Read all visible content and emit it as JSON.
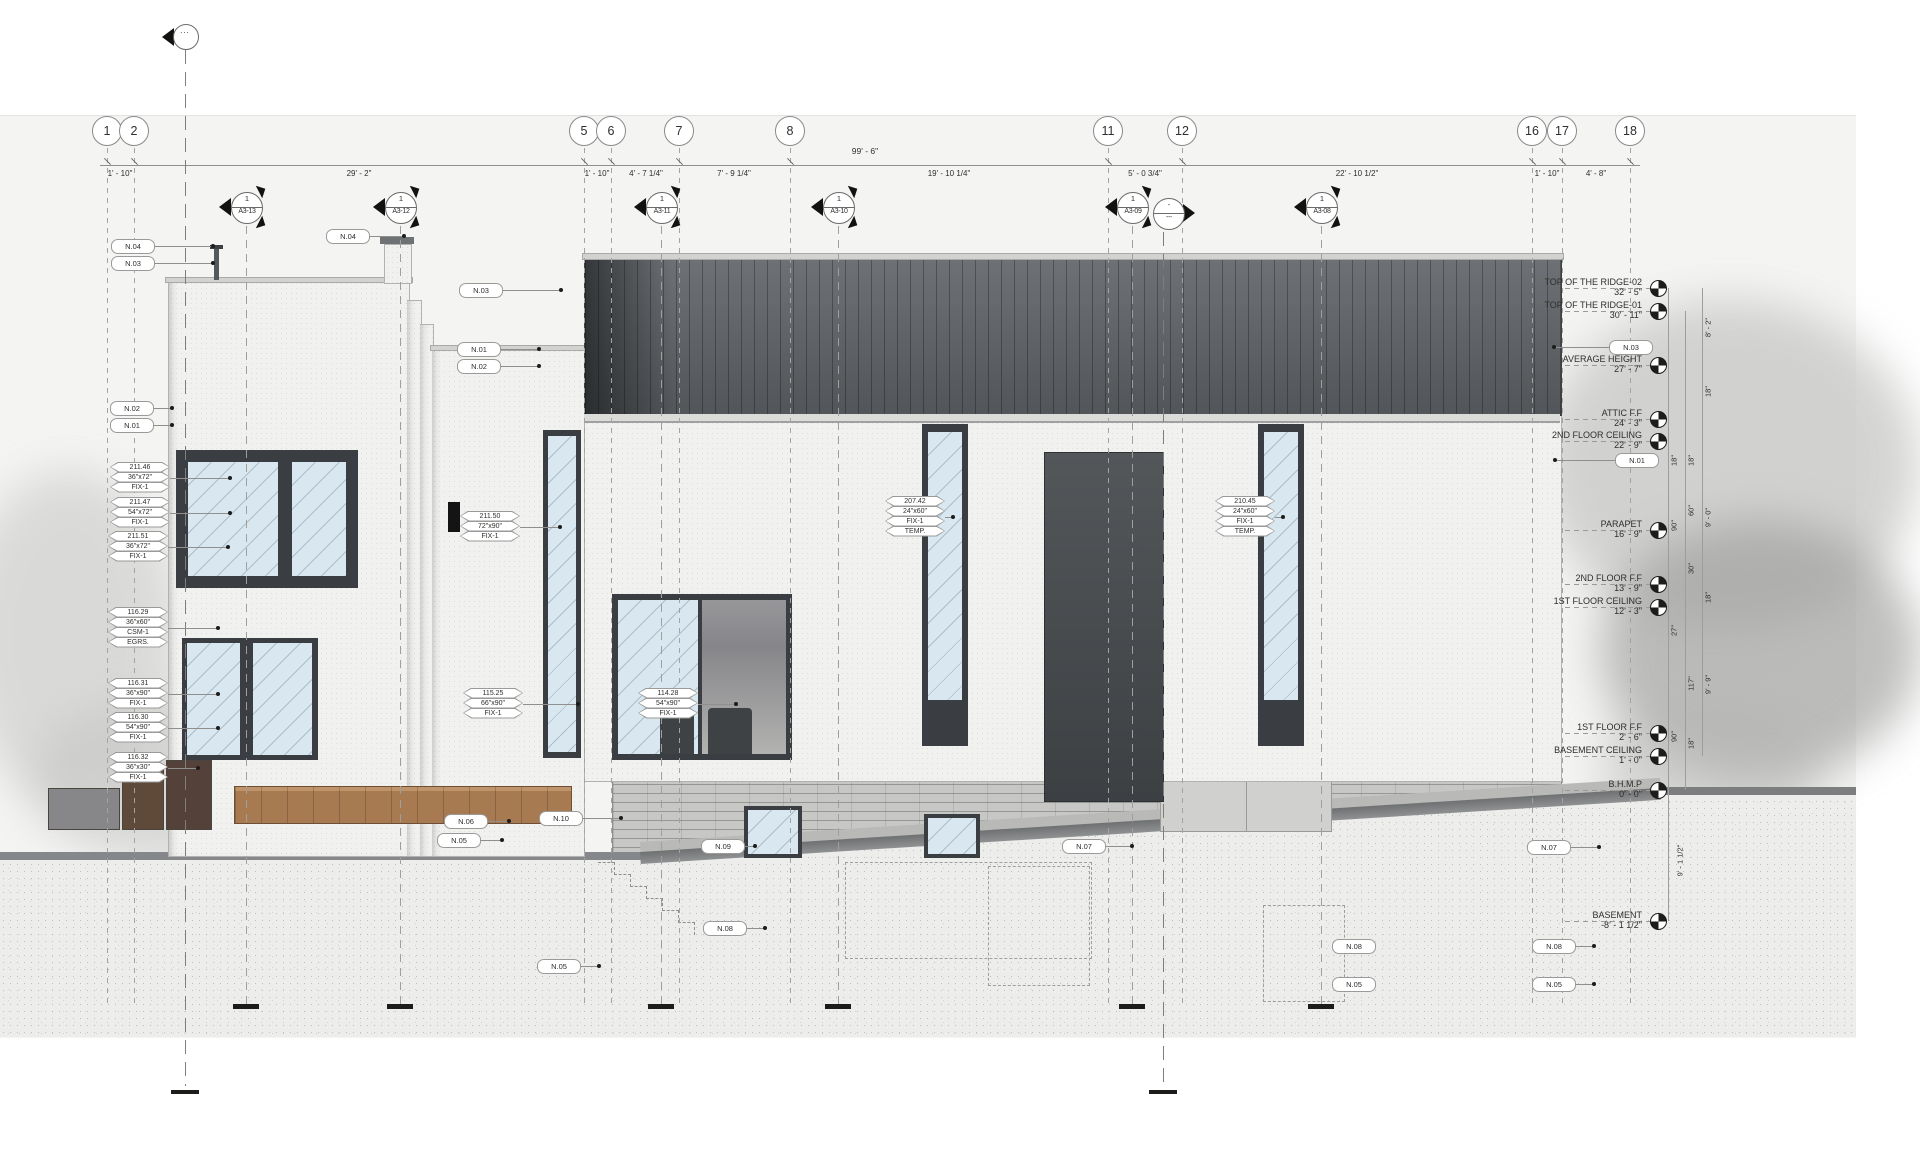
{
  "drawing": {
    "type": "building-elevation",
    "colors": {
      "sheet": "#f4f4f3",
      "roof": "#5d6165",
      "glass": "#d9e8f0",
      "frame": "#3a3e42",
      "deck": "#a87a52",
      "brick": "#c7c7c5",
      "ink": "#2e2e2c"
    }
  },
  "grids": [
    {
      "label": "1",
      "x": 107
    },
    {
      "label": "2",
      "x": 134
    },
    {
      "label": "5",
      "x": 584
    },
    {
      "label": "6",
      "x": 611
    },
    {
      "label": "7",
      "x": 679
    },
    {
      "label": "8",
      "x": 790
    },
    {
      "label": "11",
      "x": 1108
    },
    {
      "label": "12",
      "x": 1182
    },
    {
      "label": "16",
      "x": 1532
    },
    {
      "label": "17",
      "x": 1562
    },
    {
      "label": "18",
      "x": 1630
    }
  ],
  "dims": {
    "overall": "99' - 6\"",
    "overall_x": 865,
    "overall_y": 146,
    "line": {
      "x1": 100,
      "x2": 1640,
      "y": 165
    },
    "segments": [
      {
        "label": "1' - 10\"",
        "x": 120
      },
      {
        "label": "29' - 2\"",
        "x": 359
      },
      {
        "label": "1' - 10\"",
        "x": 597
      },
      {
        "label": "4' - 7 1/4\"",
        "x": 646
      },
      {
        "label": "7' - 9 1/4\"",
        "x": 734
      },
      {
        "label": "19' - 10 1/4\"",
        "x": 949
      },
      {
        "label": "5' - 0 3/4\"",
        "x": 1145
      },
      {
        "label": "22' - 10 1/2\"",
        "x": 1357
      },
      {
        "label": "1' - 10\"",
        "x": 1547
      },
      {
        "label": "4' - 8\"",
        "x": 1596
      }
    ]
  },
  "section_markers": [
    {
      "num": "1",
      "sheet": "A3-13",
      "x": 246
    },
    {
      "num": "1",
      "sheet": "A3-12",
      "x": 400
    },
    {
      "num": "1",
      "sheet": "A3-11",
      "x": 661
    },
    {
      "num": "1",
      "sheet": "A3-10",
      "x": 838
    },
    {
      "num": "1",
      "sheet": "A3-09",
      "x": 1132
    },
    {
      "num": "1",
      "sheet": "A3-08",
      "x": 1321
    }
  ],
  "aux_marker": {
    "top": "-",
    "bottom": "---",
    "x": 1168,
    "y": 213
  },
  "top_marker": {
    "label": "...",
    "x": 185,
    "y": 36
  },
  "prop_lines": [
    {
      "x": 185,
      "y1": 50,
      "y2": 1086,
      "bar_y": 1090
    },
    {
      "x": 1163,
      "y1": 232,
      "y2": 1086,
      "bar_y": 1090
    }
  ],
  "levels": [
    {
      "name": "TOP OF THE RIDGE-02",
      "elev": "32' - 5\"",
      "y": 288
    },
    {
      "name": "TOP OF THE RIDGE-01",
      "elev": "30' - 11\"",
      "y": 311
    },
    {
      "name": "AVERAGE HEIGHT",
      "elev": "27' - 7\"",
      "y": 365
    },
    {
      "name": "ATTIC F.F",
      "elev": "24' - 3\"",
      "y": 419
    },
    {
      "name": "2ND FLOOR CEILING",
      "elev": "22' - 9\"",
      "y": 441
    },
    {
      "name": "PARAPET",
      "elev": "16' - 9\"",
      "y": 530
    },
    {
      "name": "2ND FLOOR F.F",
      "elev": "13' - 9\"",
      "y": 584
    },
    {
      "name": "1ST FLOOR CEILING",
      "elev": "12' - 3\"",
      "y": 607
    },
    {
      "name": "1ST FLOOR F.F",
      "elev": "2' - 6\"",
      "y": 733
    },
    {
      "name": "BASEMENT CEILING",
      "elev": "1' - 0\"",
      "y": 756
    },
    {
      "name": "B.H.M.P",
      "elev": "0' - 0\"",
      "y": 790
    },
    {
      "name": "BASEMENT",
      "elev": "-8' - 1 1/2\"",
      "y": 921
    }
  ],
  "vdim_lines": [
    {
      "x": 1668,
      "y1": 288,
      "y2": 921
    },
    {
      "x": 1685,
      "y1": 311,
      "y2": 790
    },
    {
      "x": 1702,
      "y1": 288,
      "y2": 756
    }
  ],
  "vdims": [
    {
      "label": "8' - 2\"",
      "x": 1708,
      "y": 328
    },
    {
      "label": "18\"",
      "x": 1708,
      "y": 392
    },
    {
      "label": "18\"",
      "x": 1674,
      "y": 461
    },
    {
      "label": "18\"",
      "x": 1691,
      "y": 461
    },
    {
      "label": "90\"",
      "x": 1674,
      "y": 526
    },
    {
      "label": "60\"",
      "x": 1691,
      "y": 511
    },
    {
      "label": "9' - 0\"",
      "x": 1708,
      "y": 518
    },
    {
      "label": "30\"",
      "x": 1691,
      "y": 569
    },
    {
      "label": "18\"",
      "x": 1708,
      "y": 598
    },
    {
      "label": "27\"",
      "x": 1674,
      "y": 631
    },
    {
      "label": "117\"",
      "x": 1691,
      "y": 684
    },
    {
      "label": "9' - 9\"",
      "x": 1708,
      "y": 685
    },
    {
      "label": "90\"",
      "x": 1674,
      "y": 737
    },
    {
      "label": "18\"",
      "x": 1691,
      "y": 744
    },
    {
      "label": "9' - 1 1/2\"",
      "x": 1680,
      "y": 861
    }
  ],
  "keynotes": [
    {
      "label": "N.04",
      "x": 132,
      "y": 246,
      "dir": "r",
      "len": 60
    },
    {
      "label": "N.03",
      "x": 132,
      "y": 263,
      "dir": "r",
      "len": 60
    },
    {
      "label": "N.02",
      "x": 131,
      "y": 408,
      "dir": "r",
      "len": 20
    },
    {
      "label": "N.01",
      "x": 131,
      "y": 425,
      "dir": "r",
      "len": 20
    },
    {
      "label": "N.04",
      "x": 347,
      "y": 236,
      "dir": "r",
      "len": 36
    },
    {
      "label": "N.03",
      "x": 480,
      "y": 290,
      "dir": "r",
      "len": 60
    },
    {
      "label": "N.01",
      "x": 478,
      "y": 349,
      "dir": "r",
      "len": 40
    },
    {
      "label": "N.02",
      "x": 478,
      "y": 366,
      "dir": "r",
      "len": 40
    },
    {
      "label": "N.03",
      "x": 1630,
      "y": 347,
      "dir": "l",
      "len": 55
    },
    {
      "label": "N.01",
      "x": 1636,
      "y": 460,
      "dir": "l",
      "len": 60
    },
    {
      "label": "N.06",
      "x": 465,
      "y": 821,
      "dir": "r",
      "len": 23
    },
    {
      "label": "N.05",
      "x": 458,
      "y": 840,
      "dir": "r",
      "len": 23
    },
    {
      "label": "N.10",
      "x": 560,
      "y": 818,
      "dir": "r",
      "len": 40
    },
    {
      "label": "N.09",
      "x": 722,
      "y": 846,
      "dir": "r",
      "len": 12
    },
    {
      "label": "N.07",
      "x": 1083,
      "y": 846,
      "dir": "r",
      "len": 28
    },
    {
      "label": "N.07",
      "x": 1548,
      "y": 847,
      "dir": "r",
      "len": 30
    },
    {
      "label": "N.08",
      "x": 724,
      "y": 928,
      "dir": "r",
      "len": 20
    },
    {
      "label": "N.08",
      "x": 1353,
      "y": 946,
      "dir": "l",
      "len": 0
    },
    {
      "label": "N.08",
      "x": 1553,
      "y": 946,
      "dir": "r",
      "len": 20
    },
    {
      "label": "N.05",
      "x": 558,
      "y": 966,
      "dir": "r",
      "len": 20
    },
    {
      "label": "N.05",
      "x": 1353,
      "y": 984,
      "dir": "r",
      "len": 0
    },
    {
      "label": "N.05",
      "x": 1553,
      "y": 984,
      "dir": "r",
      "len": 20
    }
  ],
  "window_tags": [
    {
      "lines": [
        "211.46",
        "36\"x72\"",
        "FIX-1"
      ],
      "x": 140,
      "y": 478,
      "len": 60
    },
    {
      "lines": [
        "211.47",
        "54\"x72\"",
        "FIX-1"
      ],
      "x": 140,
      "y": 513,
      "len": 60
    },
    {
      "lines": [
        "211.51",
        "36\"x72\"",
        "FIX-1"
      ],
      "x": 138,
      "y": 547,
      "len": 60
    },
    {
      "lines": [
        "116.29",
        "36\"x60\"",
        "CSM-1",
        "EGRS."
      ],
      "x": 138,
      "y": 628,
      "len": 50
    },
    {
      "lines": [
        "116.31",
        "36\"x90\"",
        "FIX-1"
      ],
      "x": 138,
      "y": 694,
      "len": 50
    },
    {
      "lines": [
        "116.30",
        "54\"x90\"",
        "FIX-1"
      ],
      "x": 138,
      "y": 728,
      "len": 50
    },
    {
      "lines": [
        "116.32",
        "36\"x30\"",
        "FIX-1"
      ],
      "x": 138,
      "y": 768,
      "len": 30
    },
    {
      "lines": [
        "211.50",
        "72\"x90\"",
        "FIX-1"
      ],
      "x": 490,
      "y": 527,
      "len": 40
    },
    {
      "lines": [
        "115.25",
        "66\"x90\"",
        "FIX-1"
      ],
      "x": 493,
      "y": 704,
      "len": 55
    },
    {
      "lines": [
        "114.28",
        "54\"x90\"",
        "FIX-1"
      ],
      "x": 668,
      "y": 704,
      "len": 38
    },
    {
      "lines": [
        "207.42",
        "24\"x60\"",
        "FIX-1",
        "TEMP."
      ],
      "x": 915,
      "y": 517,
      "len": 8
    },
    {
      "lines": [
        "210.45",
        "24\"x60\"",
        "FIX-1",
        "TEMP."
      ],
      "x": 1245,
      "y": 517,
      "len": 8
    }
  ],
  "site_ticks": [
    246,
    400,
    661,
    838,
    1132,
    1321
  ]
}
